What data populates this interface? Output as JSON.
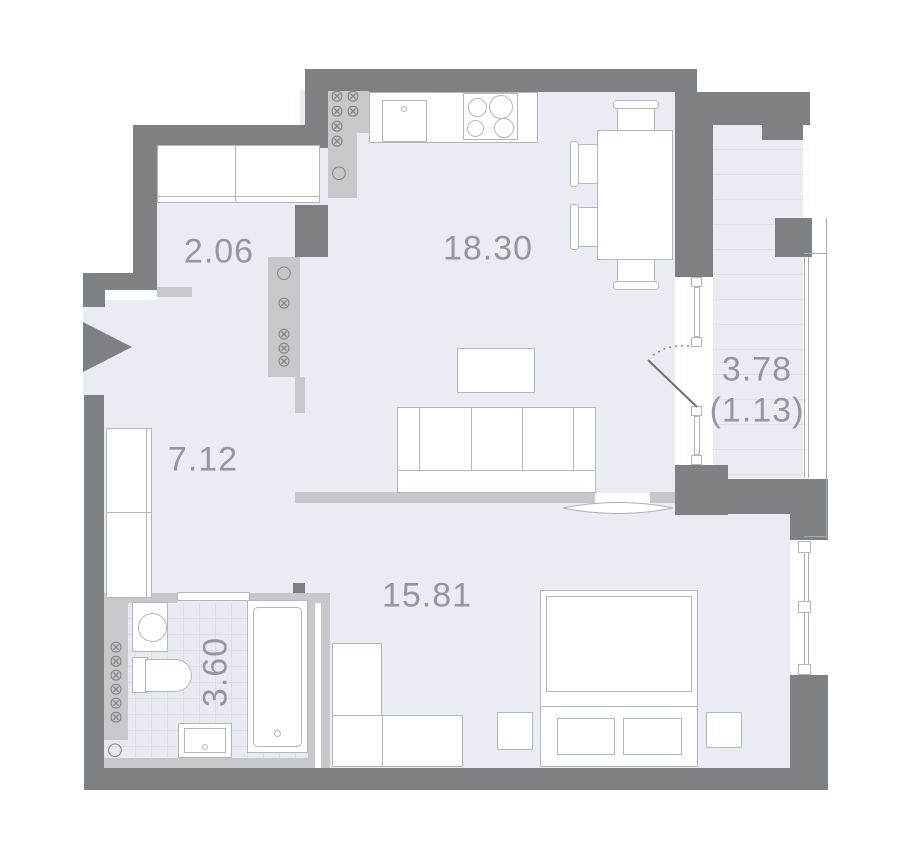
{
  "plan": {
    "title": "apartment-floor-plan",
    "rooms": [
      {
        "name": "wardrobe-niche",
        "area": "2.06"
      },
      {
        "name": "kitchen-living-room",
        "area": "18.30"
      },
      {
        "name": "hallway",
        "area": "7.12"
      },
      {
        "name": "balcony",
        "area": "3.78",
        "area_secondary": "(1.13)"
      },
      {
        "name": "bedroom",
        "area": "15.81"
      },
      {
        "name": "bathroom",
        "area": "3.60"
      }
    ],
    "symbols": {
      "vent": "⊗",
      "outlet": "○"
    },
    "colors": {
      "wall": "#7e8184",
      "light_wall": "#c6c8cb",
      "floor": "#e9ecf2",
      "furniture_outline": "#b2b7bc",
      "label_text": "#94989c",
      "background": "#ffffff"
    }
  }
}
